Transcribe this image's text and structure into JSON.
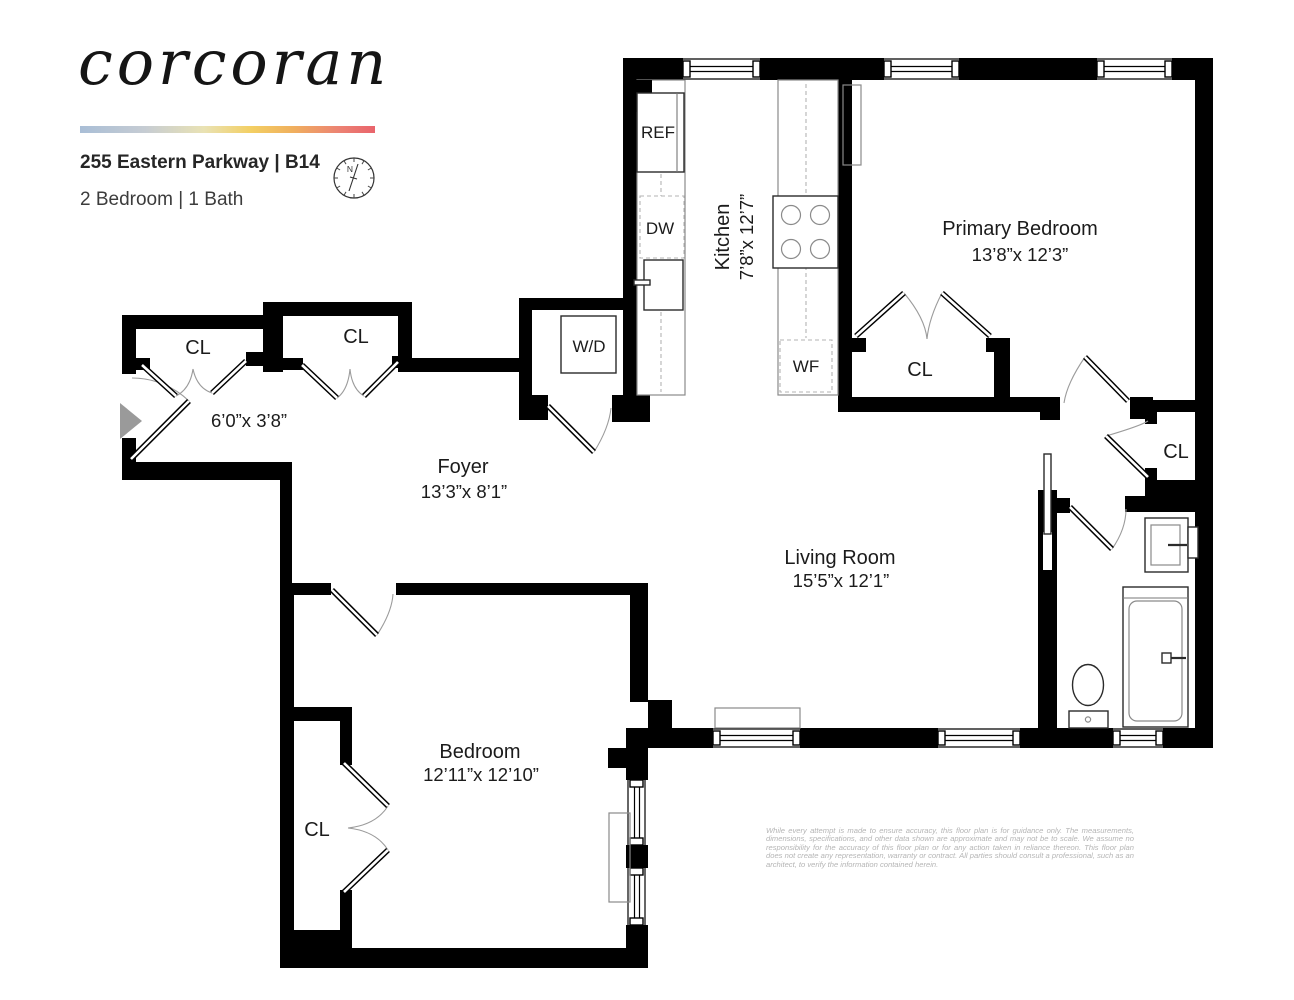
{
  "header": {
    "logo": "corcoran",
    "address": "255 Eastern Parkway | B14",
    "unit_info": "2 Bedroom | 1 Bath",
    "compass_n": "N"
  },
  "floorplan": {
    "closet_label": "CL",
    "entry_dims": "6’0”x 3’8”",
    "rooms": {
      "kitchen": {
        "name": "Kitchen",
        "dims": "7’8”x 12’7”"
      },
      "primary": {
        "name": "Primary Bedroom",
        "dims": "13’8”x 12’3”"
      },
      "living": {
        "name": "Living Room",
        "dims": "15’5”x 12’1”"
      },
      "foyer": {
        "name": "Foyer",
        "dims": "13’3”x 8’1”"
      },
      "bedroom": {
        "name": "Bedroom",
        "dims": "12’11”x 12’10”"
      }
    },
    "appliances": {
      "ref": "REF",
      "dw": "DW",
      "wd": "W/D",
      "wf": "WF"
    }
  },
  "disclaimer": {
    "text": "While every attempt is made to ensure accuracy, this floor plan is for guidance only. The measurements, dimensions, specifications, and other data shown are approximate and may not be to scale. We assume no responsibility for the accuracy of this floor plan or for any action taken in reliance thereon. This floor plan does not create any representation, warranty or contract. All parties should consult a professional, such as an architect, to verify the information contained herein."
  }
}
